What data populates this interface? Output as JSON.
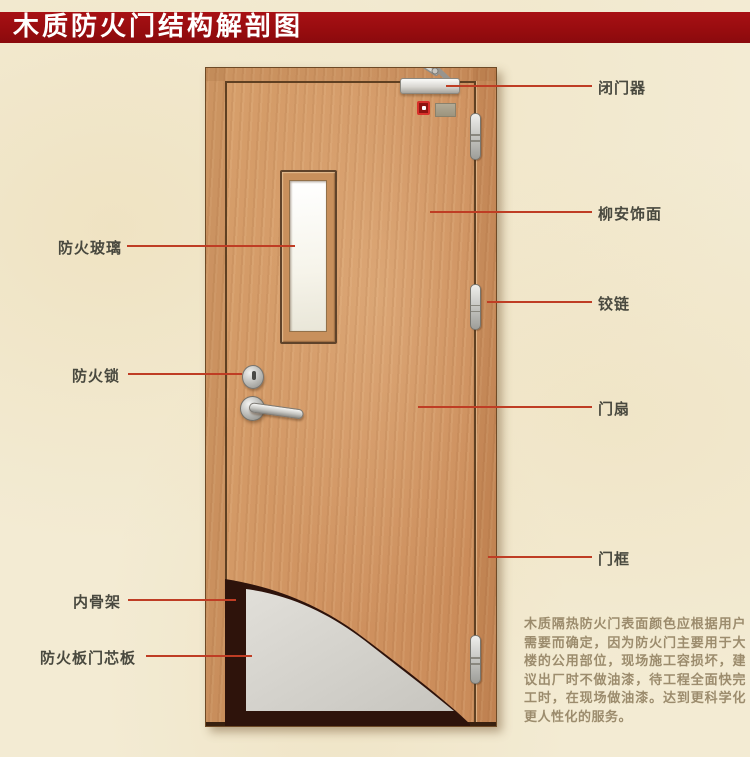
{
  "title": "木质防火门结构解剖图",
  "colors": {
    "banner_red": "#970c0f",
    "background_cream": "#f3ebd3",
    "wood": "#cf9260",
    "wood_line": "#5f4022",
    "cutaway_dark": "#2e130b",
    "core_gray": "#d8d6d0",
    "callout_line": "#bf3d24",
    "label_text": "#49493f",
    "paragraph_text": "#9c8c6d"
  },
  "labels_left": [
    {
      "id": "fire-glass",
      "text": "防火玻璃"
    },
    {
      "id": "fire-lock",
      "text": "防火锁"
    },
    {
      "id": "inner-skeleton",
      "text": "内骨架"
    },
    {
      "id": "core-board",
      "text": "防火板门芯板"
    }
  ],
  "labels_right": [
    {
      "id": "door-closer",
      "text": "闭门器"
    },
    {
      "id": "veneer",
      "text": "柳安饰面"
    },
    {
      "id": "hinge",
      "text": "铰链"
    },
    {
      "id": "door-leaf",
      "text": "门扇"
    },
    {
      "id": "door-frame",
      "text": "门框"
    }
  ],
  "description": "木质隔热防火门表面颜色应根据用户需要而确定，因为防火门主要用于大楼的公用部位，现场施工容损坏，建议出厂时不做油漆，待工程全面快完工时，在现场做油漆。达到更科学化更人性化的服务。"
}
